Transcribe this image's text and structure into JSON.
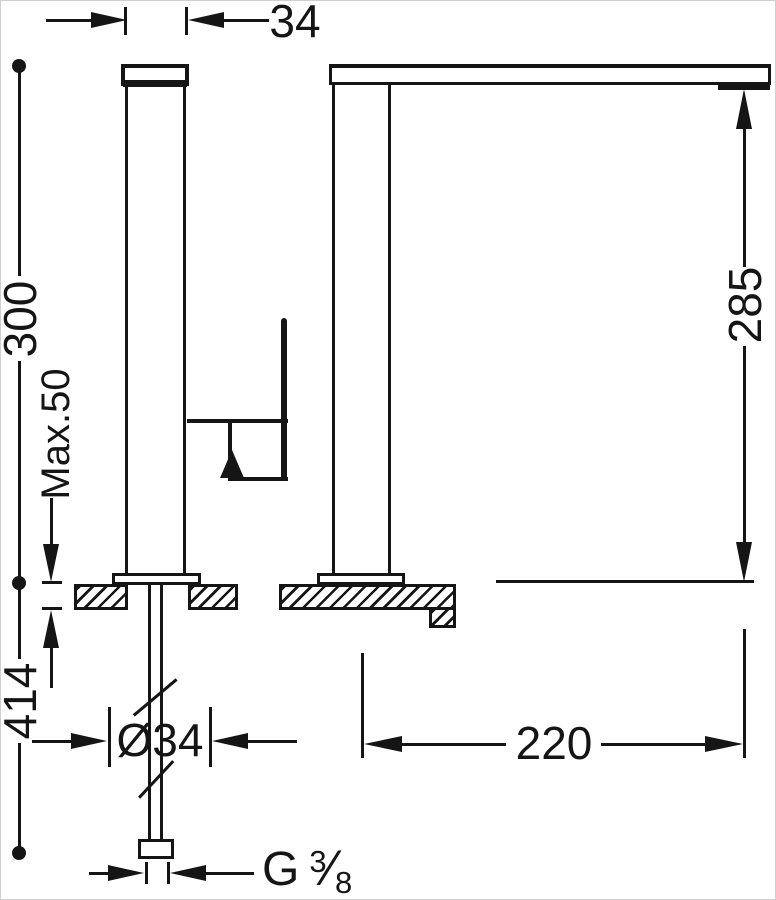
{
  "drawing": {
    "ink_color": "#151515",
    "dimensions": {
      "body_width": "34",
      "height_above_deck": "300",
      "max_deck_thickness": "Max.50",
      "outlet_height": "285",
      "under_deck_length": "414",
      "shank_diameter": "Ø34",
      "spout_reach": "220"
    },
    "thread": {
      "prefix": "G",
      "numerator": "3",
      "slash": "⁄",
      "denominator": "8"
    }
  }
}
